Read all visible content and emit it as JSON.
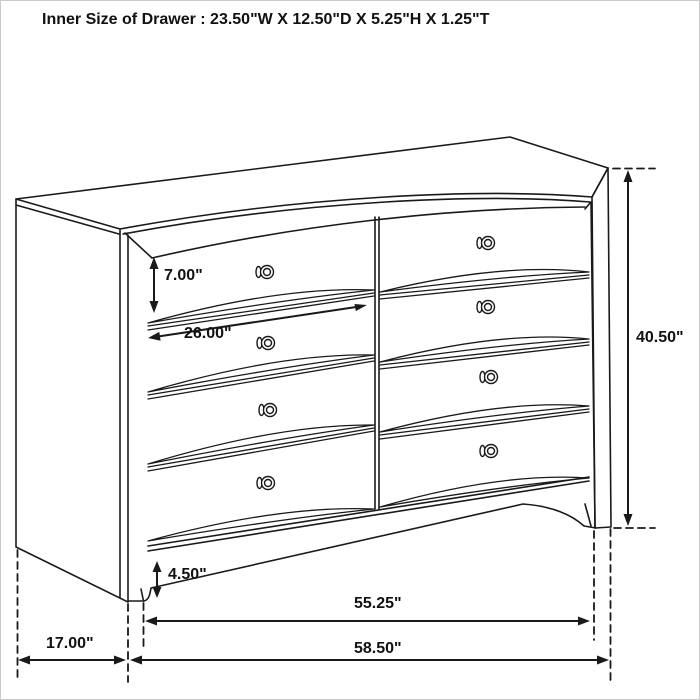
{
  "title": "Inner Size of Drawer : 23.50\"W X 12.50\"D X 5.25\"H X 1.25\"T",
  "drawing": {
    "description": "Black-and-white line drawing of an eight-drawer dresser in three-quarter perspective with dimension arrows",
    "line_color": "#1a1a1a",
    "background_color": "#ffffff"
  },
  "dimensions": {
    "drawer_front_height": "7.00\"",
    "drawer_opening_width": "26.00\"",
    "overall_height": "40.50\"",
    "base_height": "4.50\"",
    "front_width": "55.25\"",
    "side_depth": "17.00\"",
    "overall_width": "58.50\""
  }
}
